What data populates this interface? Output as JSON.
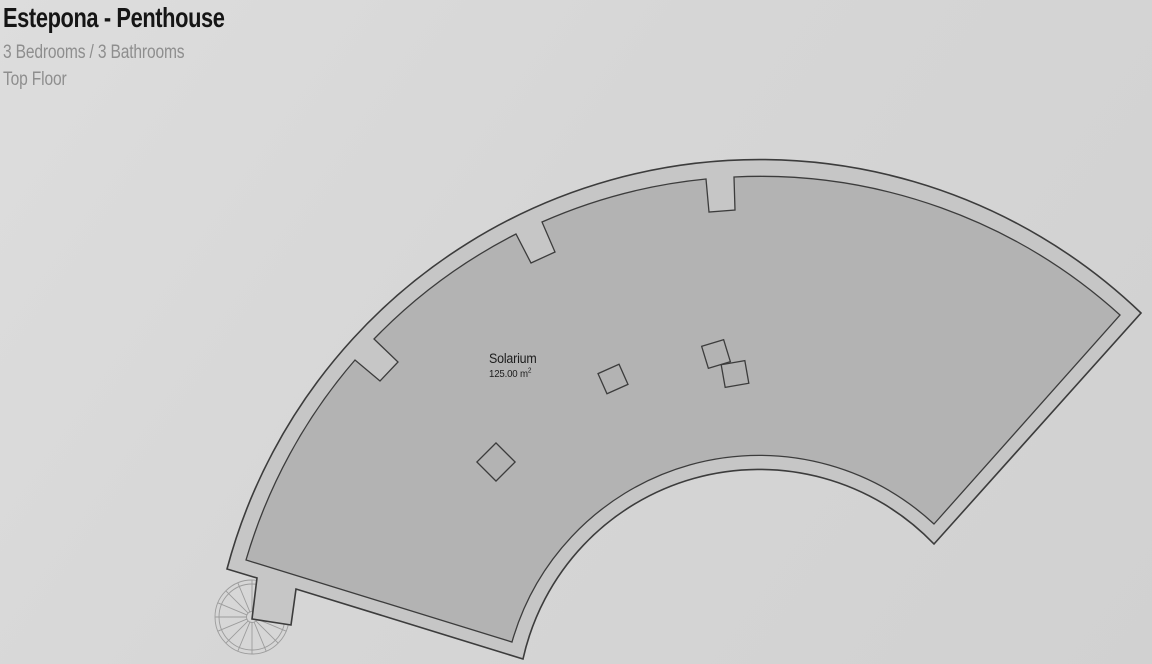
{
  "header": {
    "title": "Estepona - Penthouse",
    "subtitle": "3 Bedrooms / 3 Bathrooms",
    "floor": "Top Floor"
  },
  "plan": {
    "room": {
      "name": "Solarium",
      "area_text": "125.00 m",
      "area_sup": "2"
    },
    "icons": {
      "staircase": "spiral-staircase-icon"
    },
    "colors": {
      "background": "#d6d6d6",
      "wall_band": "#c6c6c6",
      "floor_fill": "#b3b3b3",
      "outline": "#3c3c3c",
      "stair_lines": "#9c9c9c",
      "title_text": "#151515",
      "subtitle_text": "#8e8e8e"
    }
  }
}
